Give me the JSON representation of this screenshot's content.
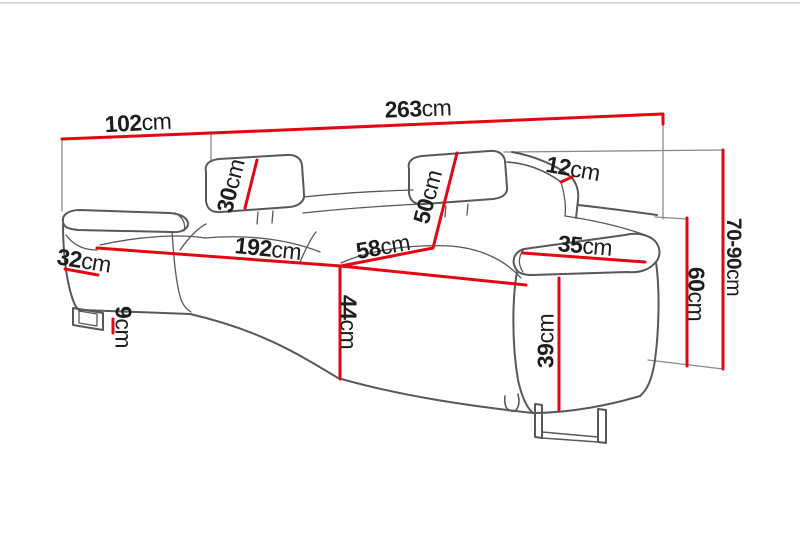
{
  "diagram": {
    "type": "sofa-dimension-diagram",
    "unit": "cm",
    "accent_color": "#e30613",
    "outline_color": "#57585a",
    "text_color": "#1d1d1b",
    "dimensions": {
      "total_width": {
        "value": "263",
        "unit": "cm"
      },
      "total_depth": {
        "value": "102",
        "unit": "cm"
      },
      "total_height_range": {
        "value": "70-90",
        "unit": "cm"
      },
      "headrest_height": {
        "value": "30",
        "unit": "cm"
      },
      "backrest_cushion_height": {
        "value": "50",
        "unit": "cm"
      },
      "backrest_top_depth": {
        "value": "12",
        "unit": "cm"
      },
      "seat_width": {
        "value": "192",
        "unit": "cm"
      },
      "seat_depth": {
        "value": "58",
        "unit": "cm"
      },
      "seat_height": {
        "value": "44",
        "unit": "cm"
      },
      "left_armrest_width": {
        "value": "32",
        "unit": "cm"
      },
      "right_armrest_width": {
        "value": "35",
        "unit": "cm"
      },
      "armrest_side_height": {
        "value": "60",
        "unit": "cm"
      },
      "armrest_front_height": {
        "value": "39",
        "unit": "cm"
      },
      "leg_height": {
        "value": "9",
        "unit": "cm"
      }
    }
  }
}
